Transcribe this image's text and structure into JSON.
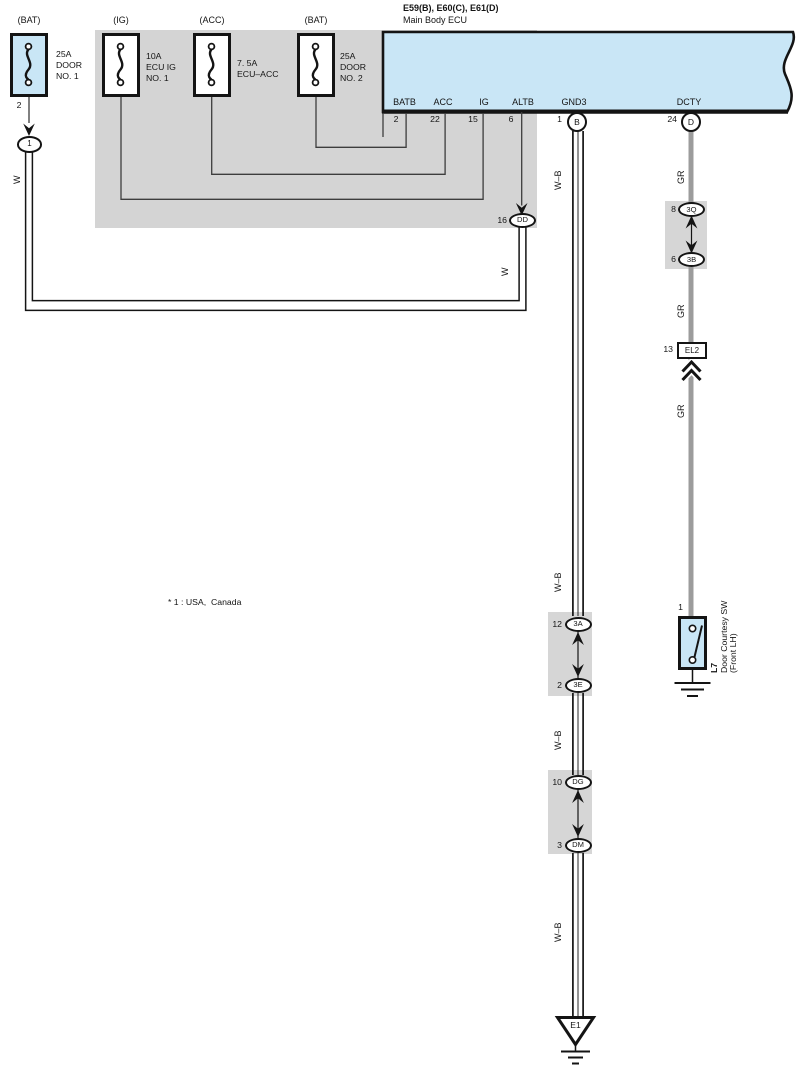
{
  "ecu": {
    "title": "E59(B), E60(C), E61(D)",
    "subtitle": "Main Body ECU",
    "pins": {
      "batb": {
        "label": "BATB",
        "num": "2"
      },
      "acc": {
        "label": "ACC",
        "num": "22"
      },
      "ig": {
        "label": "IG",
        "num": "15"
      },
      "altb": {
        "label": "ALTB",
        "num": "6"
      },
      "gnd3": {
        "label": "GND3",
        "num": "1",
        "connector": "B"
      },
      "dcty": {
        "label": "DCTY",
        "num": "24",
        "connector": "D"
      }
    }
  },
  "fuses": {
    "door_no1": {
      "source": "(BAT)",
      "rating": "25A",
      "name1": "DOOR",
      "name2": "NO. 1",
      "pin": "2"
    },
    "ecu_ig_no1": {
      "source": "(IG)",
      "rating": "10A",
      "name1": "ECU IG",
      "name2": "NO. 1"
    },
    "ecu_acc": {
      "source": "(ACC)",
      "rating": "7. 5A",
      "name1": "ECU–ACC"
    },
    "door_no2": {
      "source": "(BAT)",
      "rating": "25A",
      "name1": "DOOR",
      "name2": "NO. 2"
    }
  },
  "connectors": {
    "c1": {
      "label": "1"
    },
    "dd": {
      "num": "16",
      "label": "DD"
    },
    "q3": {
      "num": "8",
      "label": "3Q"
    },
    "b3": {
      "num": "6",
      "label": "3B"
    },
    "el2": {
      "num": "13",
      "label": "EL2"
    },
    "a3": {
      "num": "12",
      "label": "3A"
    },
    "e3": {
      "num": "2",
      "label": "3E"
    },
    "dg": {
      "num": "10",
      "label": "DG"
    },
    "dm": {
      "num": "3",
      "label": "DM"
    }
  },
  "wires": {
    "w": "W",
    "wb": "W–B",
    "gr": "GR"
  },
  "door_courtesy_switch": {
    "pin": "1",
    "code": "L7",
    "name": "Door Courtesy SW",
    "location": "(Front LH)"
  },
  "grounds": {
    "e1": "E1"
  },
  "note": "* 1 : USA,  Canada",
  "colors": {
    "component_fill": "#c9e6f6",
    "block_fill": "#d4d4d4",
    "gr_wire": "#9c9c9c",
    "line": "#141414"
  }
}
